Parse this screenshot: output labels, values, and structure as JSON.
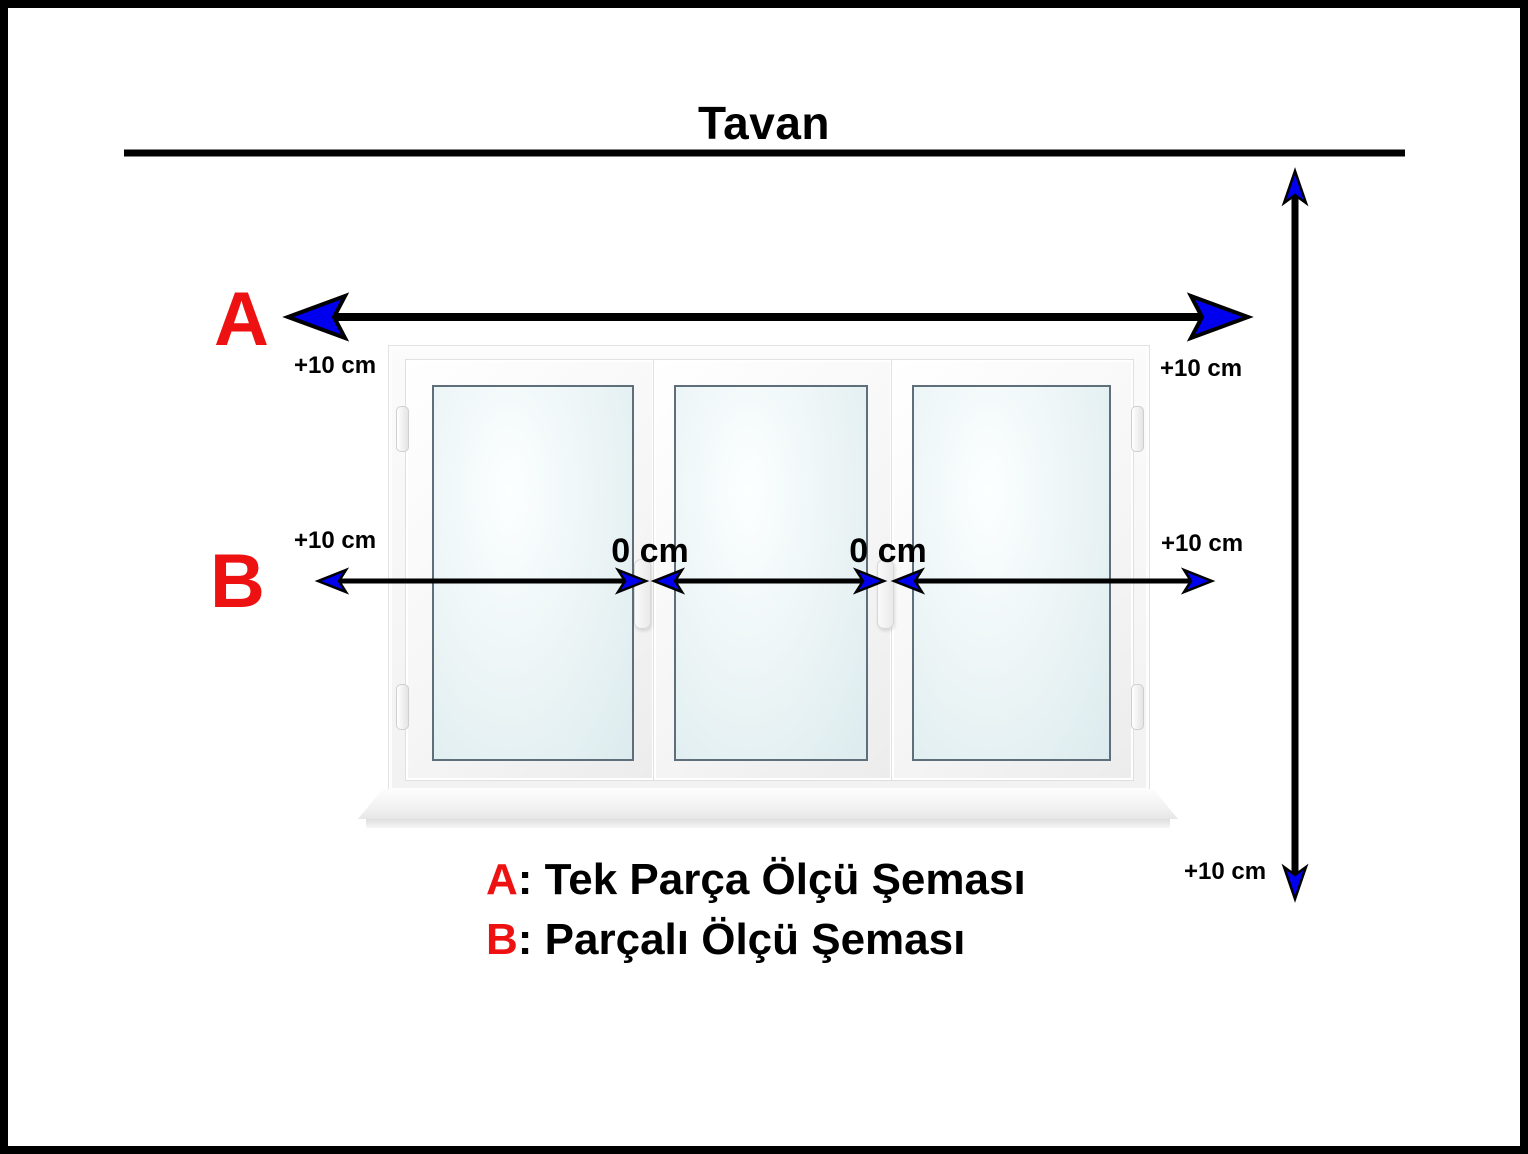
{
  "diagram": {
    "title": "Tavan",
    "marker_a": "A",
    "marker_b": "B",
    "offset_label": "+10 cm",
    "zero_label": "0 cm",
    "legend": {
      "a_key": "A",
      "a_text": ": Tek Parça Ölçü Şeması",
      "b_key": "B",
      "b_text": ": Parçalı Ölçü Şeması"
    },
    "colors": {
      "marker_red": "#ee1111",
      "arrowhead_blue": "#0000ee",
      "line_black": "#000000"
    }
  }
}
